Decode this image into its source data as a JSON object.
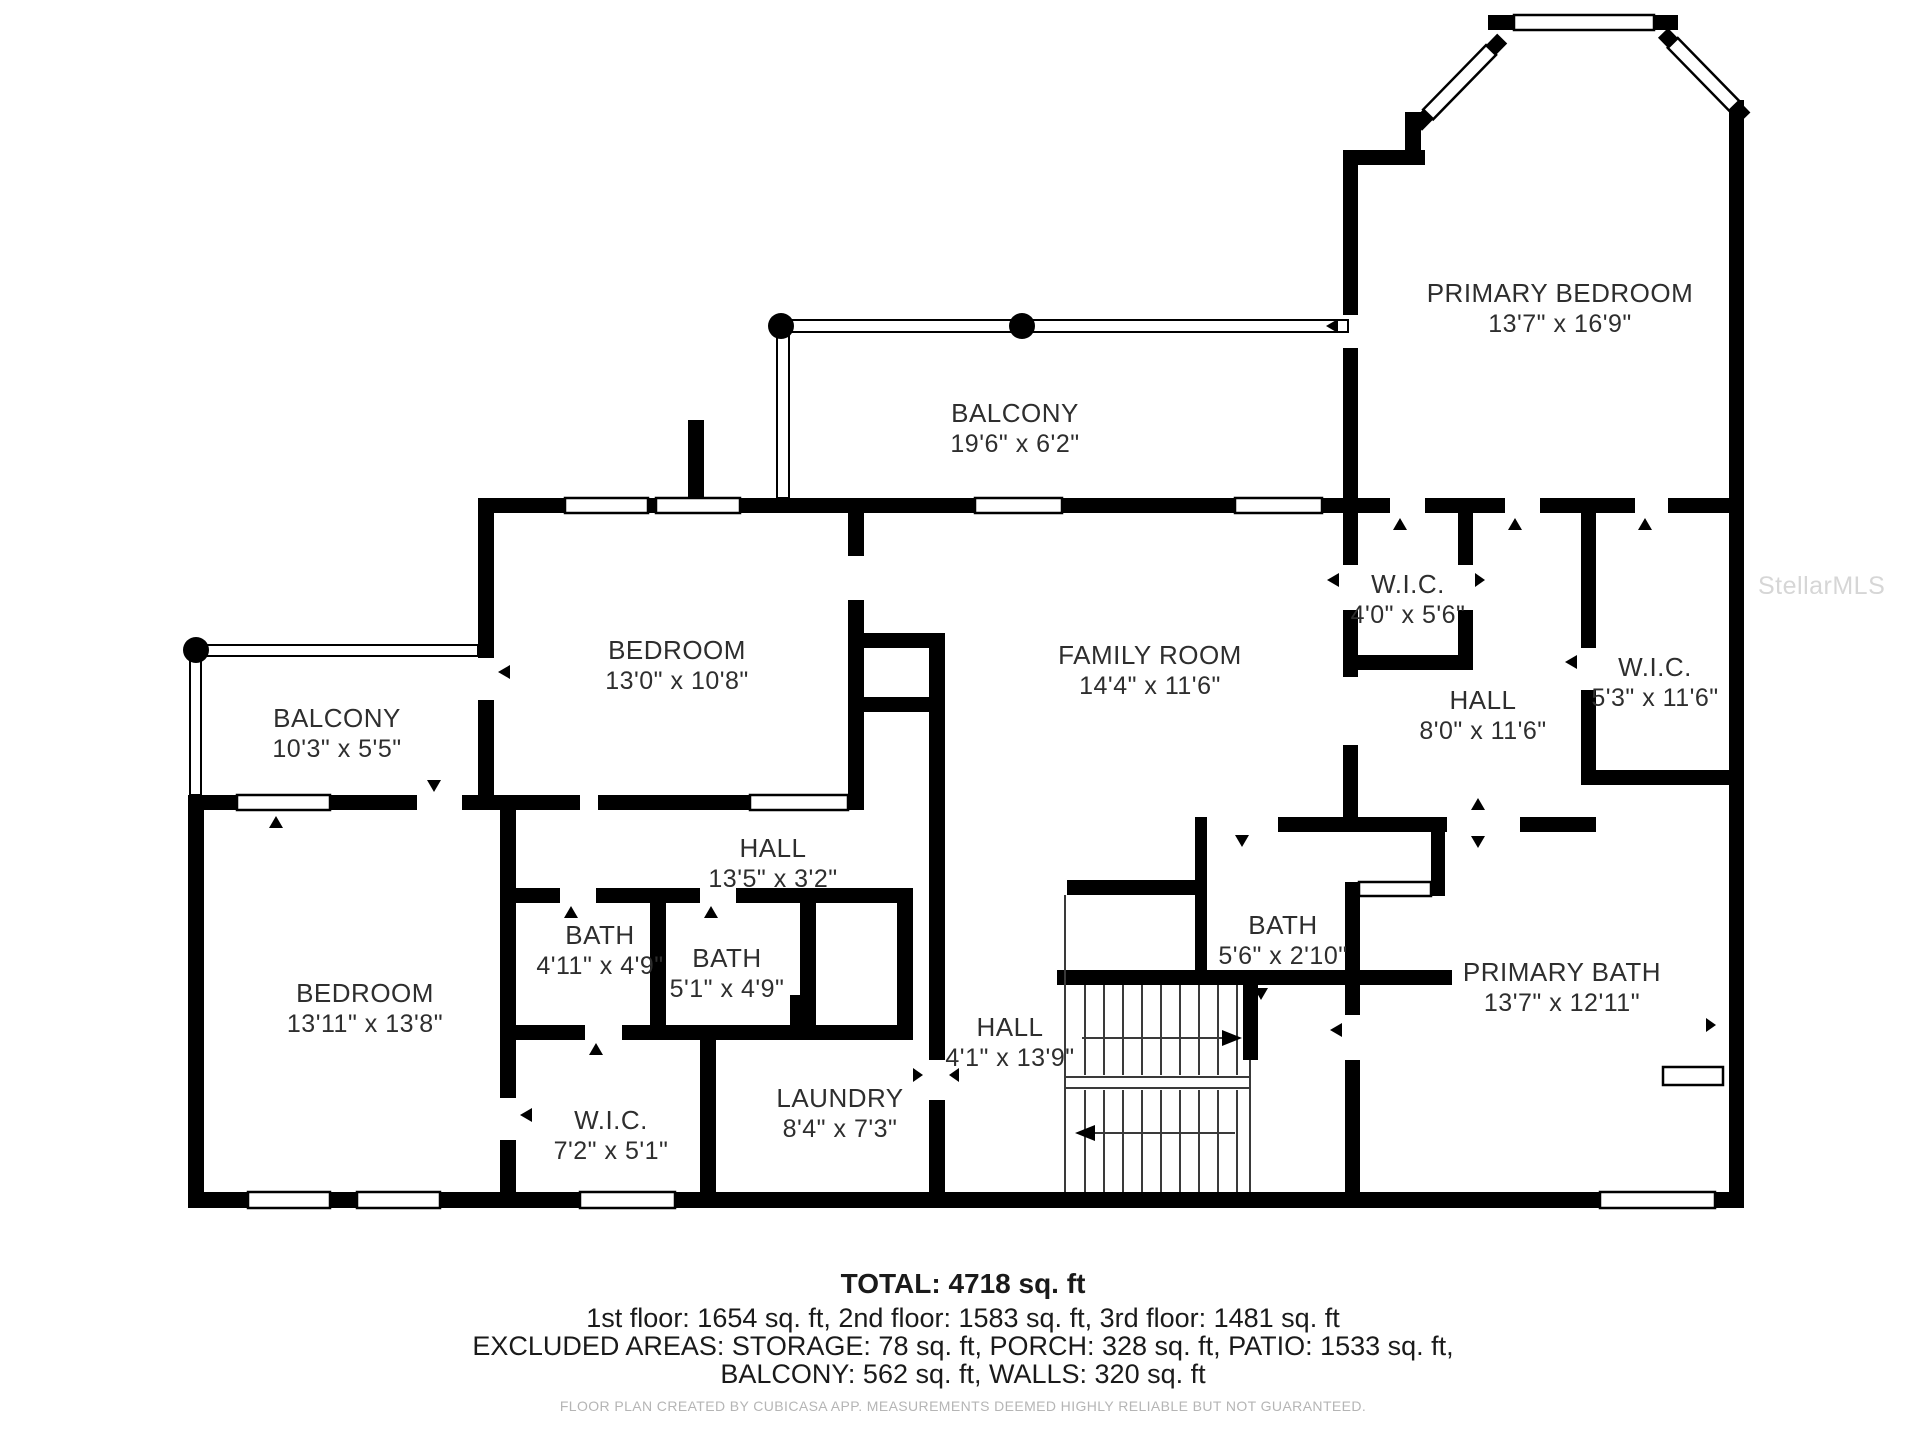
{
  "page": {
    "background": "#ffffff"
  },
  "colors": {
    "wall": "#000000",
    "label": "#2e2e2e",
    "disclaimer": "#b5b5b5",
    "watermark": "#d2d2d2"
  },
  "watermark": "StellarMLS",
  "rooms": [
    {
      "id": "primary-bedroom",
      "name": "PRIMARY BEDROOM",
      "dims": "13'7\" x 16'9\"",
      "x": 1560,
      "y": 302
    },
    {
      "id": "balcony-top",
      "name": "BALCONY",
      "dims": "19'6\" x 6'2\"",
      "x": 1015,
      "y": 422
    },
    {
      "id": "bedroom-upper",
      "name": "BEDROOM",
      "dims": "13'0\" x 10'8\"",
      "x": 677,
      "y": 659
    },
    {
      "id": "family-room",
      "name": "FAMILY ROOM",
      "dims": "14'4\" x 11'6\"",
      "x": 1150,
      "y": 664
    },
    {
      "id": "wic-top",
      "name": "W.I.C.",
      "dims": "4'0\" x 5'6\"",
      "x": 1408,
      "y": 593
    },
    {
      "id": "hall-right",
      "name": "HALL",
      "dims": "8'0\" x 11'6\"",
      "x": 1483,
      "y": 709
    },
    {
      "id": "wic-right",
      "name": "W.I.C.",
      "dims": "5'3\" x 11'6\"",
      "x": 1655,
      "y": 676
    },
    {
      "id": "balcony-left",
      "name": "BALCONY",
      "dims": "10'3\" x 5'5\"",
      "x": 337,
      "y": 727
    },
    {
      "id": "hall-mid",
      "name": "HALL",
      "dims": "13'5\" x 3'2\"",
      "x": 773,
      "y": 857
    },
    {
      "id": "bath-left",
      "name": "BATH",
      "dims": "4'11\" x 4'9\"",
      "x": 600,
      "y": 944
    },
    {
      "id": "bath-mid",
      "name": "BATH",
      "dims": "5'1\" x 4'9\"",
      "x": 727,
      "y": 967
    },
    {
      "id": "bath-small",
      "name": "BATH",
      "dims": "5'6\" x 2'10\"",
      "x": 1283,
      "y": 934
    },
    {
      "id": "bedroom-lower",
      "name": "BEDROOM",
      "dims": "13'11\" x 13'8\"",
      "x": 365,
      "y": 1002
    },
    {
      "id": "hall-lower",
      "name": "HALL",
      "dims": "4'1\" x 13'9\"",
      "x": 1010,
      "y": 1036
    },
    {
      "id": "primary-bath",
      "name": "PRIMARY BATH",
      "dims": "13'7\" x 12'11\"",
      "x": 1562,
      "y": 981
    },
    {
      "id": "wic-lower",
      "name": "W.I.C.",
      "dims": "7'2\" x 5'1\"",
      "x": 611,
      "y": 1129
    },
    {
      "id": "laundry",
      "name": "LAUNDRY",
      "dims": "8'4\" x 7'3\"",
      "x": 840,
      "y": 1107
    }
  ],
  "footer": {
    "total": "TOTAL: 4718 sq. ft",
    "floors": "1st floor: 1654 sq. ft, 2nd floor: 1583 sq. ft, 3rd floor: 1481 sq. ft",
    "excluded": "EXCLUDED AREAS: STORAGE: 78 sq. ft, PORCH: 328 sq. ft, PATIO: 1533 sq. ft,",
    "excluded2": "BALCONY: 562 sq. ft, WALLS: 320 sq. ft",
    "disclaimer": "FLOOR PLAN CREATED BY CUBICASA APP. MEASUREMENTS DEEMED HIGHLY RELIABLE BUT NOT GUARANTEED."
  }
}
